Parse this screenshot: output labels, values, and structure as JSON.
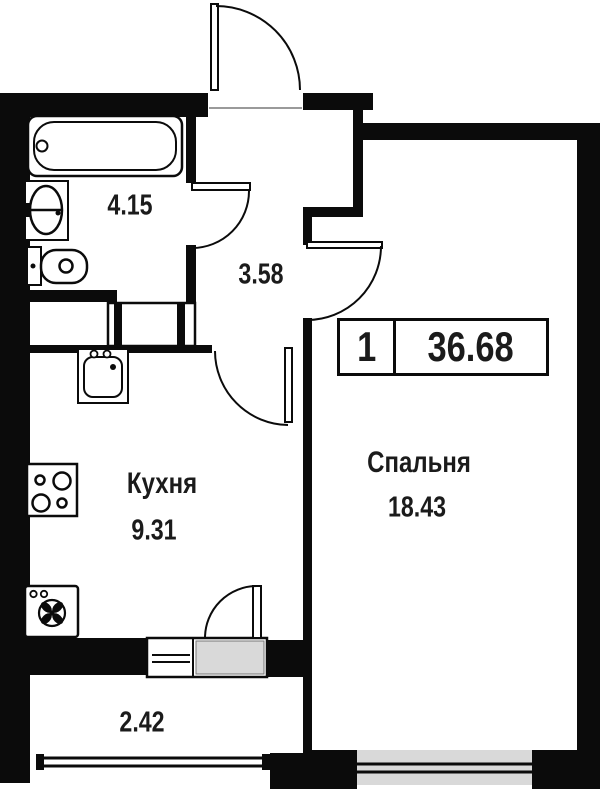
{
  "badge": {
    "rooms_count": "1",
    "total_area": "36.68"
  },
  "rooms": {
    "bathroom": {
      "area": "4.15"
    },
    "hallway": {
      "area": "3.58"
    },
    "kitchen": {
      "name": "Кухня",
      "area": "9.31"
    },
    "bedroom": {
      "name": "Спальня",
      "area": "18.43"
    },
    "balcony": {
      "area": "2.42"
    }
  },
  "fixtures": [
    "bathtub",
    "bathroom-sink",
    "toilet",
    "duct-shaft",
    "kitchen-sink",
    "stove",
    "washing-machine"
  ],
  "doors": [
    "entrance-door",
    "bathroom-door",
    "bedroom-door",
    "kitchen-door",
    "balcony-door"
  ],
  "windows": [
    "balcony-window",
    "bedroom-window"
  ],
  "colors": {
    "wall": "#0b0b0b",
    "window_fill": "#d9d9d9",
    "background": "#ffffff",
    "text": "#1b1b1b"
  }
}
